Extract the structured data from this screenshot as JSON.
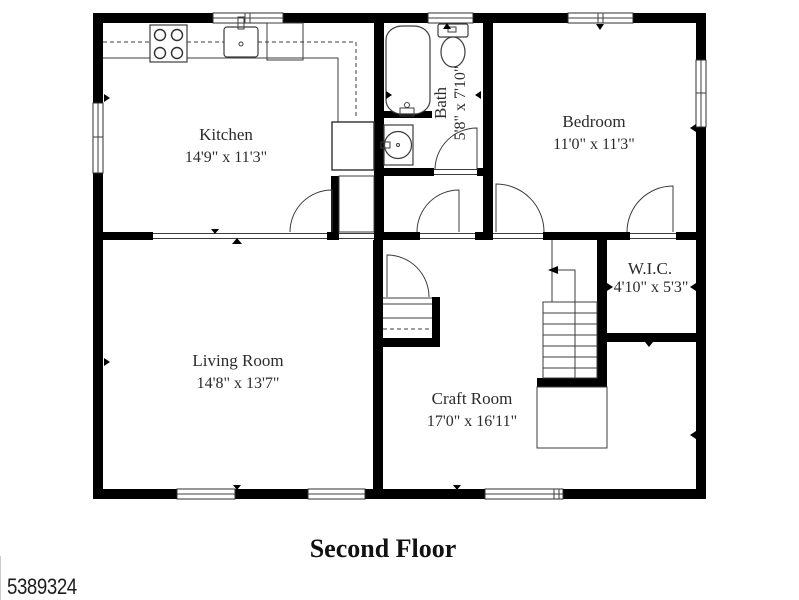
{
  "plan": {
    "title": "Second Floor",
    "listing_id": "5389324",
    "rooms": {
      "kitchen": {
        "name": "Kitchen",
        "dims": "14'9\" x 11'3\""
      },
      "bath": {
        "name": "Bath",
        "dims": "5'8\" x 7'10\""
      },
      "bedroom": {
        "name": "Bedroom",
        "dims": "11'0\" x 11'3\""
      },
      "living_room": {
        "name": "Living Room",
        "dims": "14'8\" x 13'7\""
      },
      "wic": {
        "name": "W.I.C.",
        "dims": "4'10\" x 5'3\""
      },
      "craft_room": {
        "name": "Craft Room",
        "dims": "17'0\" x 16'11\""
      }
    },
    "fixtures": [
      "stove",
      "kitchen-sink",
      "dishwasher",
      "bathtub",
      "toilet",
      "vanity-sink",
      "staircase"
    ],
    "colors": {
      "wall": "#000000",
      "background": "#ffffff",
      "line": "#3c3c3c"
    }
  }
}
